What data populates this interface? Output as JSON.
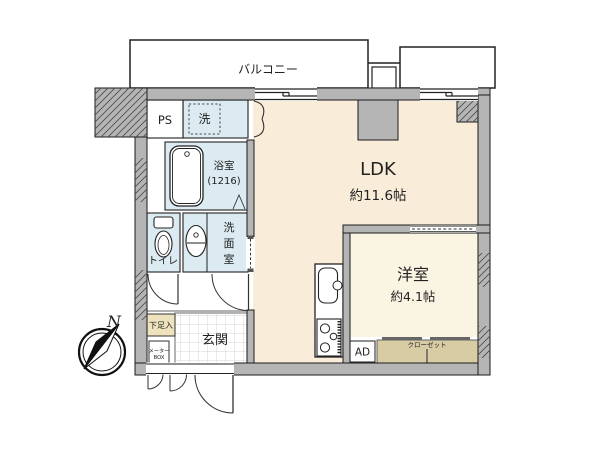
{
  "colors": {
    "wall": "#b5b5b5",
    "outline": "#1a1a1a",
    "floor_ldk": "#f9edd9",
    "floor_western": "#faf4e3",
    "floor_wet": "#dcebf2",
    "floor_closet": "#d8cca4",
    "floor_shoebox": "#eee3bd",
    "floor_white": "#ffffff"
  },
  "rooms": {
    "balcony": {
      "label": "バルコニー"
    },
    "ldk": {
      "label": "LDK",
      "size": "約11.6帖"
    },
    "western": {
      "label": "洋室",
      "size": "約4.1帖"
    },
    "bath": {
      "label": "浴室",
      "size": "(1216)"
    },
    "washroom": {
      "chars": [
        "洗",
        "面",
        "室"
      ]
    },
    "toilet": {
      "label": "トイレ"
    },
    "laundry": {
      "label": "洗"
    },
    "ps": {
      "label": "PS"
    },
    "genkan": {
      "label": "玄関"
    },
    "shoe_box": {
      "label": "下足入"
    },
    "meter_box": {
      "line1": "メーター",
      "line2": "BOX"
    },
    "ad": {
      "label": "AD"
    },
    "closet": {
      "label": "クローゼット"
    },
    "compass": {
      "label": "N"
    }
  }
}
